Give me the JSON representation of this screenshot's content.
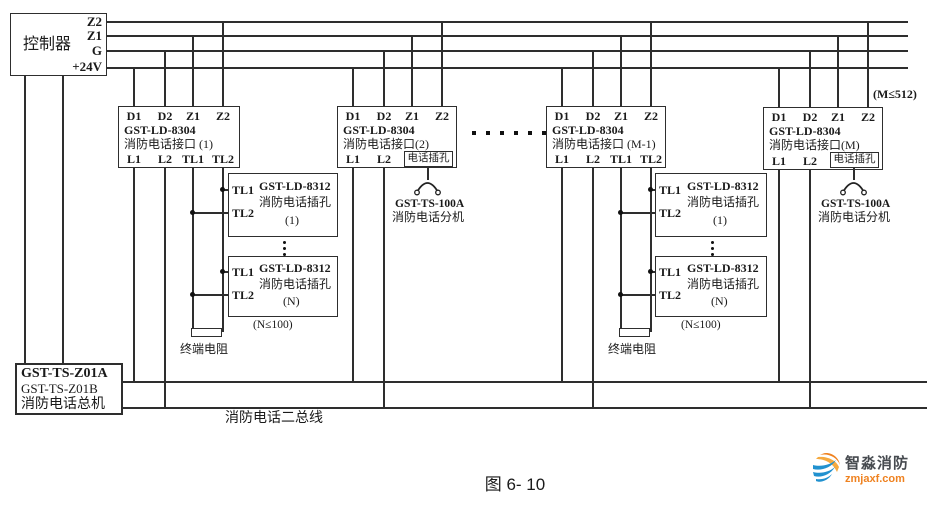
{
  "controller": {
    "label": "控制器",
    "terminals": [
      "Z2",
      "Z1",
      "G",
      "+24V"
    ]
  },
  "master_box": {
    "line1": "GST-TS-Z01A",
    "line2": "GST-TS-Z01B",
    "line3": "消防电话总机"
  },
  "bus2_label": "消防电话二总线",
  "caption": "图 6- 10",
  "annotations": {
    "m_limit": "(M≤512)",
    "n_limit": "(N≤100)",
    "terminal_resistor": "终端电阻"
  },
  "interface_boxes": [
    {
      "top_terminals": [
        "D1",
        "D2",
        "Z1",
        "Z2"
      ],
      "model": "GST-LD-8304",
      "name": "消防电话接口 (1)",
      "bottom_terminals": [
        "L1",
        "L2",
        "TL1",
        "TL2"
      ]
    },
    {
      "top_terminals": [
        "D1",
        "D2",
        "Z1",
        "Z2"
      ],
      "model": "GST-LD-8304",
      "name": "消防电话接口(2)",
      "bottom_terminals": [
        "L1",
        "L2"
      ],
      "jack_label": "电话插孔"
    },
    {
      "top_terminals": [
        "D1",
        "D2",
        "Z1",
        "Z2"
      ],
      "model": "GST-LD-8304",
      "name": "消防电话接口 (M-1)",
      "bottom_terminals": [
        "L1",
        "L2",
        "TL1",
        "TL2"
      ]
    },
    {
      "top_terminals": [
        "D1",
        "D2",
        "Z1",
        "Z2"
      ],
      "model": "GST-LD-8304",
      "name": "消防电话接口(M)",
      "bottom_terminals": [
        "L1",
        "L2"
      ],
      "jack_label": "电话插孔"
    }
  ],
  "phone_jack_module": {
    "tl1": "TL1",
    "tl2": "TL2",
    "model": "GST-LD-8312",
    "name": "消防电话插孔",
    "index_first": "(1)",
    "index_last": "(N)"
  },
  "extension": {
    "model": "GST-TS-100A",
    "name": "消防电话分机"
  },
  "logo": {
    "name": "智淼消防",
    "site": "zmjaxf.com",
    "orange": "#ef8220",
    "blue": "#2191cf"
  }
}
